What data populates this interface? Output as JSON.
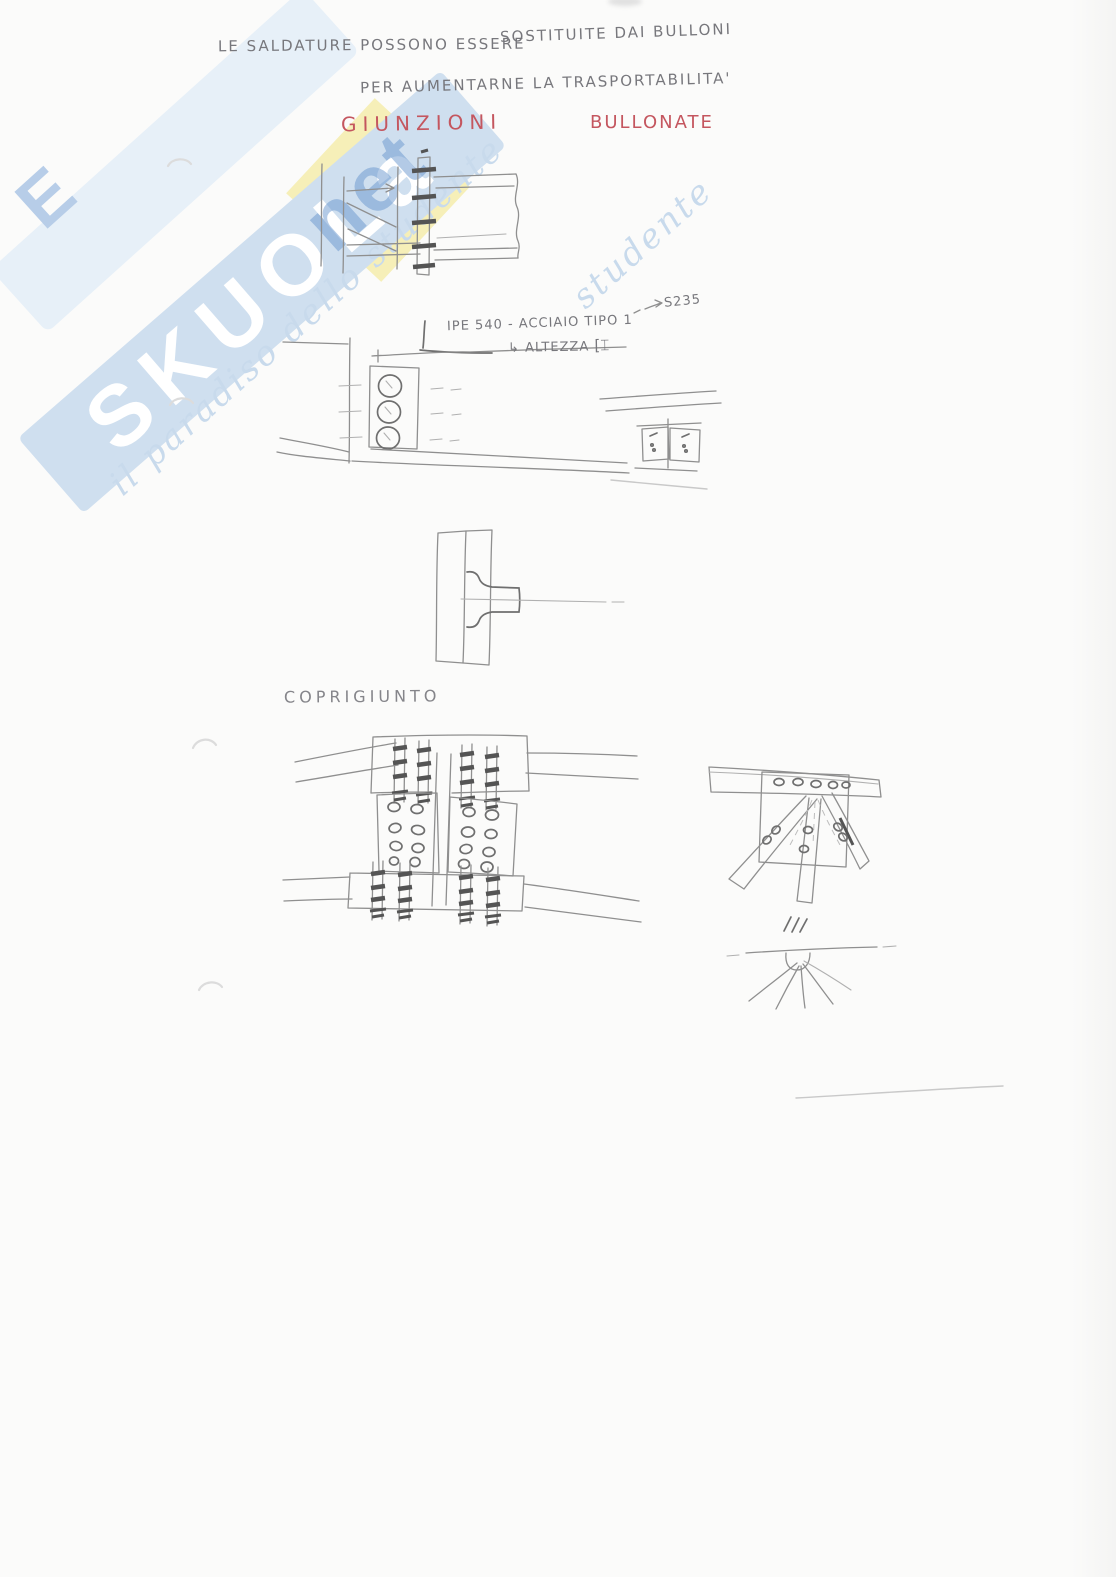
{
  "document": {
    "kind": "scanned handwritten engineering note",
    "notes": {
      "line1a": "LE SALDATURE POSSONO ESSERE",
      "line1b": "SOSTITUITE DAI BULLONI",
      "line2": "PER AUMENTARNE LA TRASPORTABILITA'"
    },
    "title": {
      "word1": "GIUNZIONI",
      "word2": "BULLONATE",
      "color": "#c4565f"
    },
    "annotations": {
      "steel_grade": "S235",
      "profile_note": "IPE 540 - ACCIAIO TIPO 1",
      "height_arrow": "↳",
      "height_note": "ALTEZZA",
      "section_symbol": "[⌶"
    },
    "labels": {
      "cover_joint": "COPRIGIUNTO"
    },
    "watermark": {
      "brand": "SKUOLa",
      "suffix": "net",
      "fragment": "E",
      "tagline": "il paradiso dello studente",
      "tagline_fragment": "studente",
      "band_color": "#cfdfef",
      "stripe_color": "#e7f0f8",
      "diamond_color": "#f5eeb4",
      "brand_text_color": "#ffffff",
      "suffix_color": "rgba(104,150,205,0.5)",
      "tagline_color": "#c8daec"
    },
    "pencil": {
      "stroke": "#8f8f8f",
      "dark": "#545454",
      "light": "#b0b0b0"
    }
  }
}
